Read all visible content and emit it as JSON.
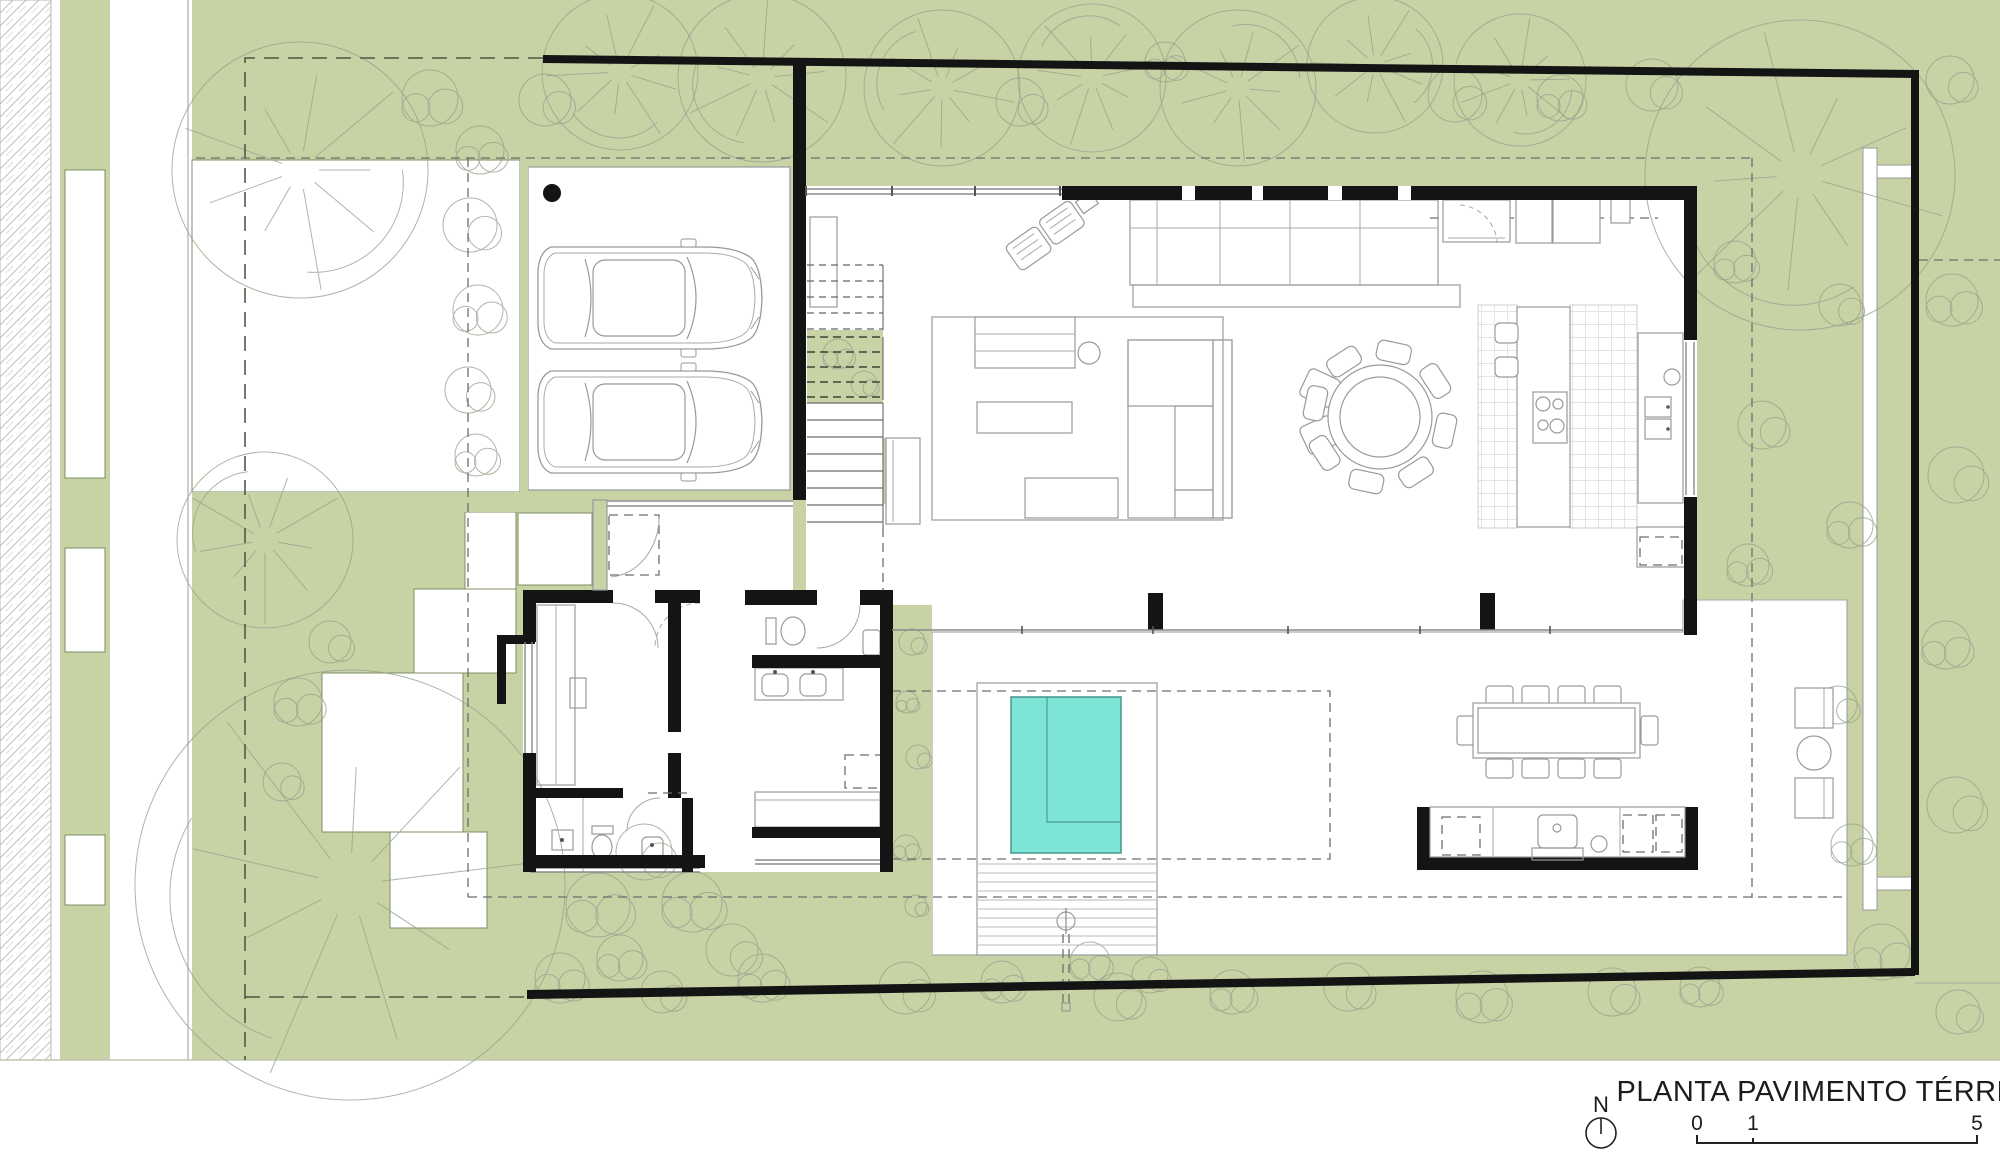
{
  "title_block": {
    "title": "PLANTA PAVIMENTO TÉRREO",
    "north_label": "N",
    "scale_labels": [
      "0",
      "1",
      "5"
    ]
  },
  "colors": {
    "lawn_green": "#c7d3a4",
    "pool_teal": "#7ee5d6",
    "pool_edge": "#4d9c92",
    "wall_black": "#141414",
    "line_gray": "#9a9a9a",
    "tree_gray": "#9aa38f",
    "hatch_gray": "#bfbfbf",
    "paper_white": "#ffffff"
  },
  "plan": {
    "stairs": {
      "x": 807,
      "w": 76,
      "flights": [
        {
          "y0": 265,
          "y1": 330,
          "step": 16,
          "style": "dashed"
        },
        {
          "y0": 337,
          "y1": 400,
          "step": 15,
          "style": "dashedDark"
        },
        {
          "y0": 403,
          "y1": 528,
          "step": 17,
          "style": "solid"
        }
      ]
    },
    "deck": {
      "x0": 978,
      "x1": 1156,
      "y0": 864,
      "y1": 953,
      "step": 9
    },
    "pool": {
      "x": 1011,
      "y": 697,
      "w": 110,
      "h": 156,
      "ledge_x": 1047,
      "ledge_y": 822
    },
    "dining_round": {
      "cx": 1380,
      "cy": 417,
      "r_outer": 52,
      "r_inner": 40,
      "chairs": 8,
      "chair_w": 34,
      "chair_h": 20,
      "chair_r": 66,
      "angle_offset": 12
    },
    "cars": [
      {
        "x": 535,
        "y": 243
      },
      {
        "x": 535,
        "y": 367
      }
    ],
    "outdoor_table": {
      "x": 1473,
      "y": 703,
      "w": 167,
      "h": 55
    },
    "outdoor_chair_cols": [
      1486,
      1522,
      1558,
      1594
    ],
    "outdoor_chair_rows": {
      "top": 686,
      "bottom": 759,
      "left_x": 1457,
      "right_x": 1641,
      "mid_y": 716
    },
    "scale_bar": {
      "x0": 1697,
      "x1": 1977,
      "xm": 1753,
      "y": 1143
    }
  },
  "landscape": {
    "trees": [
      [
        "f",
        300,
        170,
        128
      ],
      [
        "f",
        620,
        72,
        78
      ],
      [
        "f",
        762,
        78,
        84
      ],
      [
        "f",
        942,
        88,
        78
      ],
      [
        "f",
        1092,
        78,
        74
      ],
      [
        "f",
        1238,
        88,
        78
      ],
      [
        "f",
        1375,
        65,
        68
      ],
      [
        "f",
        1520,
        80,
        66
      ],
      [
        "f",
        1800,
        175,
        155
      ],
      [
        "f",
        350,
        885,
        215
      ],
      [
        "f",
        265,
        540,
        88
      ],
      [
        "b",
        480,
        150,
        24
      ],
      [
        "b",
        470,
        225,
        27
      ],
      [
        "b",
        478,
        310,
        25
      ],
      [
        "b",
        468,
        390,
        23
      ],
      [
        "b",
        476,
        455,
        21
      ],
      [
        "b",
        545,
        100,
        26
      ],
      [
        "b",
        430,
        98,
        28
      ],
      [
        "b",
        1020,
        102,
        24
      ],
      [
        "b",
        1165,
        62,
        20
      ],
      [
        "b",
        1455,
        95,
        27
      ],
      [
        "b",
        1560,
        98,
        23
      ],
      [
        "b",
        1652,
        85,
        26
      ],
      [
        "b",
        1735,
        262,
        21
      ],
      [
        "b",
        1762,
        425,
        24
      ],
      [
        "b",
        1748,
        565,
        21
      ],
      [
        "b",
        1840,
        305,
        21
      ],
      [
        "b",
        1850,
        525,
        23
      ],
      [
        "b",
        1838,
        705,
        19
      ],
      [
        "b",
        1852,
        845,
        21
      ],
      [
        "b",
        1950,
        80,
        24
      ],
      [
        "b",
        1952,
        300,
        26
      ],
      [
        "b",
        1956,
        475,
        28
      ],
      [
        "b",
        1946,
        645,
        24
      ],
      [
        "b",
        1955,
        805,
        28
      ],
      [
        "b",
        1882,
        952,
        28
      ],
      [
        "b",
        1958,
        1012,
        22
      ],
      [
        "b",
        560,
        978,
        25
      ],
      [
        "b",
        662,
        992,
        21
      ],
      [
        "b",
        762,
        978,
        24
      ],
      [
        "b",
        905,
        988,
        26
      ],
      [
        "b",
        1002,
        982,
        21
      ],
      [
        "b",
        1118,
        997,
        24
      ],
      [
        "b",
        1232,
        992,
        22
      ],
      [
        "b",
        1348,
        987,
        24
      ],
      [
        "b",
        1482,
        997,
        26
      ],
      [
        "b",
        1612,
        992,
        24
      ],
      [
        "b",
        1700,
        987,
        20
      ],
      [
        "b",
        912,
        642,
        13
      ],
      [
        "b",
        907,
        702,
        11
      ],
      [
        "b",
        918,
        757,
        12
      ],
      [
        "b",
        906,
        848,
        13
      ],
      [
        "b",
        916,
        906,
        11
      ],
      [
        "b",
        838,
        354,
        15
      ],
      [
        "b",
        864,
        384,
        13
      ],
      [
        "b",
        598,
        905,
        32
      ],
      [
        "b",
        644,
        852,
        28
      ],
      [
        "b",
        692,
        902,
        30
      ],
      [
        "b",
        732,
        950,
        26
      ],
      [
        "b",
        620,
        958,
        23
      ],
      [
        "b",
        330,
        642,
        21
      ],
      [
        "b",
        298,
        702,
        24
      ],
      [
        "b",
        282,
        782,
        19
      ],
      [
        "b",
        1090,
        962,
        20
      ],
      [
        "b",
        1150,
        975,
        18
      ]
    ]
  }
}
